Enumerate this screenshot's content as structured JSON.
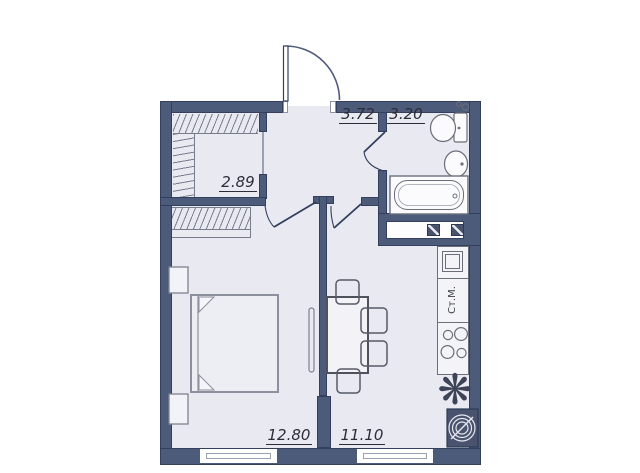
{
  "title": "apartment-floor-plan",
  "rooms": [
    {
      "name": "dressing-room",
      "area": "2.89"
    },
    {
      "name": "hallway",
      "area": "3.72"
    },
    {
      "name": "bathroom",
      "area": "3.20"
    },
    {
      "name": "bedroom",
      "area": "12.80"
    },
    {
      "name": "kitchen-living",
      "area": "11.10"
    }
  ],
  "labels": {
    "washing_machine": "Ст.М."
  },
  "colors": {
    "wall": "#4d5b7b",
    "floor": "#e9e9f2",
    "background": "#ffffff",
    "fixture_line": "#6a6f7a",
    "text": "#2b2e36"
  }
}
